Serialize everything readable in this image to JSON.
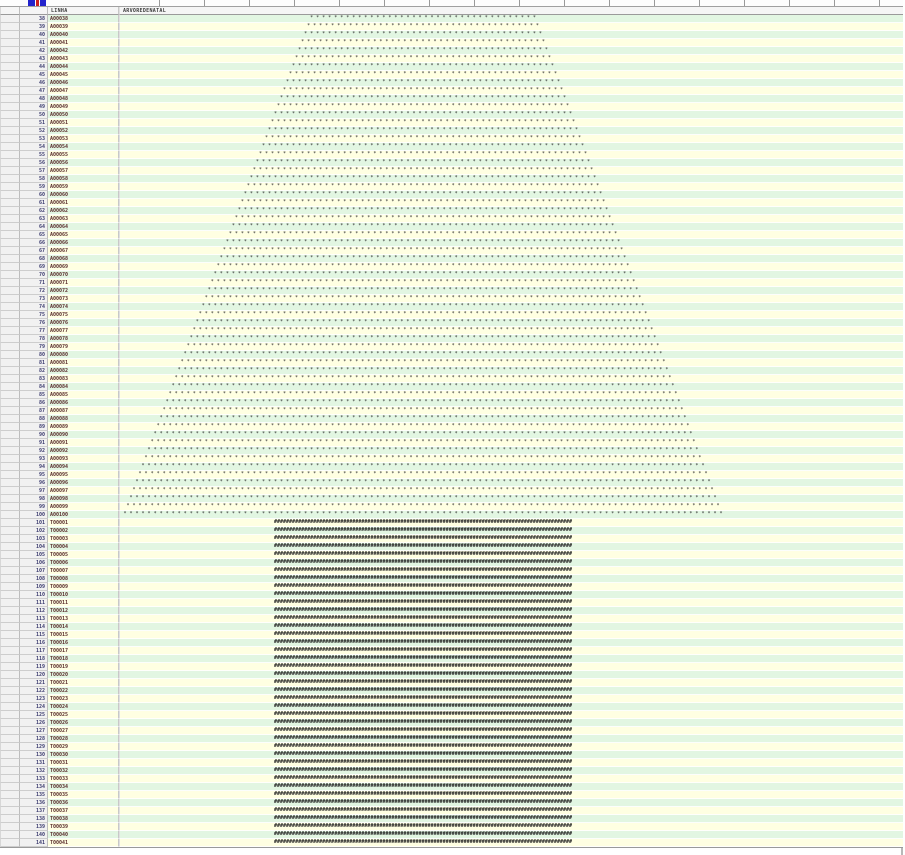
{
  "header": {
    "linha_label": "LINHA",
    "tree_label": "ARVOREDENATAL"
  },
  "colors": {
    "row_green": "#e2f6e2",
    "row_cream": "#ffffe2",
    "star_color": "#2b2b2b",
    "trunk_color": "#1e1e1e",
    "num_text": "#3a3a6e",
    "linha_text": "#5a2d2d",
    "icon_blue": "#2323cc",
    "icon_red": "#cc2020"
  },
  "art": {
    "star_char": "*",
    "trunk_char": "#"
  },
  "rows": [
    {
      "num": 38,
      "linha": "A00038",
      "type": "star",
      "count": 38
    },
    {
      "num": 39,
      "linha": "A00039",
      "type": "star",
      "count": 39
    },
    {
      "num": 40,
      "linha": "A00040",
      "type": "star",
      "count": 40
    },
    {
      "num": 41,
      "linha": "A00041",
      "type": "star",
      "count": 41
    },
    {
      "num": 42,
      "linha": "A00042",
      "type": "star",
      "count": 42
    },
    {
      "num": 43,
      "linha": "A00043",
      "type": "star",
      "count": 43
    },
    {
      "num": 44,
      "linha": "A00044",
      "type": "star",
      "count": 44
    },
    {
      "num": 45,
      "linha": "A00045",
      "type": "star",
      "count": 45
    },
    {
      "num": 46,
      "linha": "A00046",
      "type": "star",
      "count": 46
    },
    {
      "num": 47,
      "linha": "A00047",
      "type": "star",
      "count": 47
    },
    {
      "num": 48,
      "linha": "A00048",
      "type": "star",
      "count": 48
    },
    {
      "num": 49,
      "linha": "A00049",
      "type": "star",
      "count": 49
    },
    {
      "num": 50,
      "linha": "A00050",
      "type": "star",
      "count": 50
    },
    {
      "num": 51,
      "linha": "A00051",
      "type": "star",
      "count": 51
    },
    {
      "num": 52,
      "linha": "A00052",
      "type": "star",
      "count": 52
    },
    {
      "num": 53,
      "linha": "A00053",
      "type": "star",
      "count": 53
    },
    {
      "num": 54,
      "linha": "A00054",
      "type": "star",
      "count": 54
    },
    {
      "num": 55,
      "linha": "A00055",
      "type": "star",
      "count": 55
    },
    {
      "num": 56,
      "linha": "A00056",
      "type": "star",
      "count": 56
    },
    {
      "num": 57,
      "linha": "A00057",
      "type": "star",
      "count": 57
    },
    {
      "num": 58,
      "linha": "A00058",
      "type": "star",
      "count": 58
    },
    {
      "num": 59,
      "linha": "A00059",
      "type": "star",
      "count": 59
    },
    {
      "num": 60,
      "linha": "A00060",
      "type": "star",
      "count": 60
    },
    {
      "num": 61,
      "linha": "A00061",
      "type": "star",
      "count": 61
    },
    {
      "num": 62,
      "linha": "A00062",
      "type": "star",
      "count": 62
    },
    {
      "num": 63,
      "linha": "A00063",
      "type": "star",
      "count": 63
    },
    {
      "num": 64,
      "linha": "A00064",
      "type": "star",
      "count": 64
    },
    {
      "num": 65,
      "linha": "A00065",
      "type": "star",
      "count": 65
    },
    {
      "num": 66,
      "linha": "A00066",
      "type": "star",
      "count": 66
    },
    {
      "num": 67,
      "linha": "A00067",
      "type": "star",
      "count": 67
    },
    {
      "num": 68,
      "linha": "A00068",
      "type": "star",
      "count": 68
    },
    {
      "num": 69,
      "linha": "A00069",
      "type": "star",
      "count": 69
    },
    {
      "num": 70,
      "linha": "A00070",
      "type": "star",
      "count": 70
    },
    {
      "num": 71,
      "linha": "A00071",
      "type": "star",
      "count": 71
    },
    {
      "num": 72,
      "linha": "A00072",
      "type": "star",
      "count": 72
    },
    {
      "num": 73,
      "linha": "A00073",
      "type": "star",
      "count": 73
    },
    {
      "num": 74,
      "linha": "A00074",
      "type": "star",
      "count": 74
    },
    {
      "num": 75,
      "linha": "A00075",
      "type": "star",
      "count": 75
    },
    {
      "num": 76,
      "linha": "A00076",
      "type": "star",
      "count": 76
    },
    {
      "num": 77,
      "linha": "A00077",
      "type": "star",
      "count": 77
    },
    {
      "num": 78,
      "linha": "A00078",
      "type": "star",
      "count": 78
    },
    {
      "num": 79,
      "linha": "A00079",
      "type": "star",
      "count": 79
    },
    {
      "num": 80,
      "linha": "A00080",
      "type": "star",
      "count": 80
    },
    {
      "num": 81,
      "linha": "A00081",
      "type": "star",
      "count": 81
    },
    {
      "num": 82,
      "linha": "A00082",
      "type": "star",
      "count": 82
    },
    {
      "num": 83,
      "linha": "A00083",
      "type": "star",
      "count": 83
    },
    {
      "num": 84,
      "linha": "A00084",
      "type": "star",
      "count": 84
    },
    {
      "num": 85,
      "linha": "A00085",
      "type": "star",
      "count": 85
    },
    {
      "num": 86,
      "linha": "A00086",
      "type": "star",
      "count": 86
    },
    {
      "num": 87,
      "linha": "A00087",
      "type": "star",
      "count": 87
    },
    {
      "num": 88,
      "linha": "A00088",
      "type": "star",
      "count": 88
    },
    {
      "num": 89,
      "linha": "A00089",
      "type": "star",
      "count": 89
    },
    {
      "num": 90,
      "linha": "A00090",
      "type": "star",
      "count": 90
    },
    {
      "num": 91,
      "linha": "A00091",
      "type": "star",
      "count": 91
    },
    {
      "num": 92,
      "linha": "A00092",
      "type": "star",
      "count": 92
    },
    {
      "num": 93,
      "linha": "A00093",
      "type": "star",
      "count": 93
    },
    {
      "num": 94,
      "linha": "A00094",
      "type": "star",
      "count": 94
    },
    {
      "num": 95,
      "linha": "A00095",
      "type": "star",
      "count": 95
    },
    {
      "num": 96,
      "linha": "A00096",
      "type": "star",
      "count": 96
    },
    {
      "num": 97,
      "linha": "A00097",
      "type": "star",
      "count": 97
    },
    {
      "num": 98,
      "linha": "A00098",
      "type": "star",
      "count": 98
    },
    {
      "num": 99,
      "linha": "A00099",
      "type": "star",
      "count": 99
    },
    {
      "num": 100,
      "linha": "A00100",
      "type": "star",
      "count": 100
    },
    {
      "num": 101,
      "linha": "T00001",
      "type": "trunk",
      "count": 99
    },
    {
      "num": 102,
      "linha": "T00002",
      "type": "trunk",
      "count": 99
    },
    {
      "num": 103,
      "linha": "T00003",
      "type": "trunk",
      "count": 99
    },
    {
      "num": 104,
      "linha": "T00004",
      "type": "trunk",
      "count": 99
    },
    {
      "num": 105,
      "linha": "T00005",
      "type": "trunk",
      "count": 99
    },
    {
      "num": 106,
      "linha": "T00006",
      "type": "trunk",
      "count": 99
    },
    {
      "num": 107,
      "linha": "T00007",
      "type": "trunk",
      "count": 99
    },
    {
      "num": 108,
      "linha": "T00008",
      "type": "trunk",
      "count": 99
    },
    {
      "num": 109,
      "linha": "T00009",
      "type": "trunk",
      "count": 99
    },
    {
      "num": 110,
      "linha": "T00010",
      "type": "trunk",
      "count": 99
    },
    {
      "num": 111,
      "linha": "T00011",
      "type": "trunk",
      "count": 99
    },
    {
      "num": 112,
      "linha": "T00012",
      "type": "trunk",
      "count": 99
    },
    {
      "num": 113,
      "linha": "T00013",
      "type": "trunk",
      "count": 99
    },
    {
      "num": 114,
      "linha": "T00014",
      "type": "trunk",
      "count": 99
    },
    {
      "num": 115,
      "linha": "T00015",
      "type": "trunk",
      "count": 99
    },
    {
      "num": 116,
      "linha": "T00016",
      "type": "trunk",
      "count": 99
    },
    {
      "num": 117,
      "linha": "T00017",
      "type": "trunk",
      "count": 99
    },
    {
      "num": 118,
      "linha": "T00018",
      "type": "trunk",
      "count": 99
    },
    {
      "num": 119,
      "linha": "T00019",
      "type": "trunk",
      "count": 99
    },
    {
      "num": 120,
      "linha": "T00020",
      "type": "trunk",
      "count": 99
    },
    {
      "num": 121,
      "linha": "T00021",
      "type": "trunk",
      "count": 99
    },
    {
      "num": 122,
      "linha": "T00022",
      "type": "trunk",
      "count": 99
    },
    {
      "num": 123,
      "linha": "T00023",
      "type": "trunk",
      "count": 99
    },
    {
      "num": 124,
      "linha": "T00024",
      "type": "trunk",
      "count": 99
    },
    {
      "num": 125,
      "linha": "T00025",
      "type": "trunk",
      "count": 99
    },
    {
      "num": 126,
      "linha": "T00026",
      "type": "trunk",
      "count": 99
    },
    {
      "num": 127,
      "linha": "T00027",
      "type": "trunk",
      "count": 99
    },
    {
      "num": 128,
      "linha": "T00028",
      "type": "trunk",
      "count": 99
    },
    {
      "num": 129,
      "linha": "T00029",
      "type": "trunk",
      "count": 99
    },
    {
      "num": 130,
      "linha": "T00030",
      "type": "trunk",
      "count": 99
    },
    {
      "num": 131,
      "linha": "T00031",
      "type": "trunk",
      "count": 99
    },
    {
      "num": 132,
      "linha": "T00032",
      "type": "trunk",
      "count": 99
    },
    {
      "num": 133,
      "linha": "T00033",
      "type": "trunk",
      "count": 99
    },
    {
      "num": 134,
      "linha": "T00034",
      "type": "trunk",
      "count": 99
    },
    {
      "num": 135,
      "linha": "T00035",
      "type": "trunk",
      "count": 99
    },
    {
      "num": 136,
      "linha": "T00036",
      "type": "trunk",
      "count": 99
    },
    {
      "num": 137,
      "linha": "T00037",
      "type": "trunk",
      "count": 99
    },
    {
      "num": 138,
      "linha": "T00038",
      "type": "trunk",
      "count": 99
    },
    {
      "num": 139,
      "linha": "T00039",
      "type": "trunk",
      "count": 99
    },
    {
      "num": 140,
      "linha": "T00040",
      "type": "trunk",
      "count": 99
    },
    {
      "num": 141,
      "linha": "T00041",
      "type": "trunk",
      "count": 99
    }
  ]
}
